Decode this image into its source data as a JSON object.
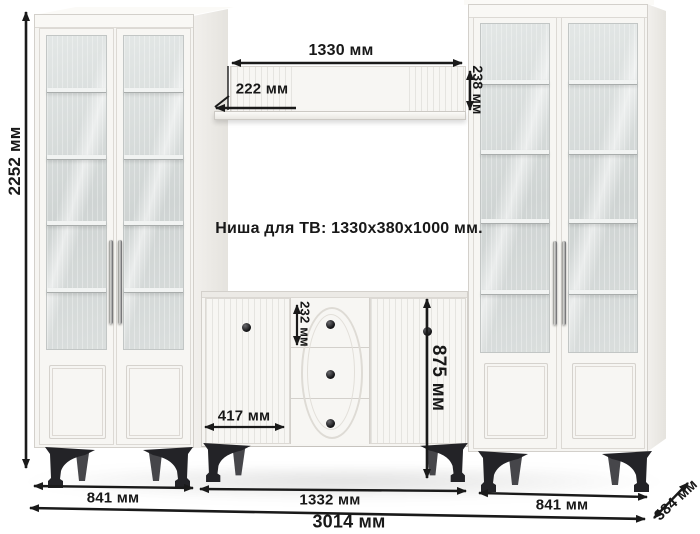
{
  "annotations": {
    "tv_niche_text": "Ниша для ТВ: 1330x380x1000 мм."
  },
  "dimensions": {
    "total_height": "2252 мм",
    "shelf_width": "1330 мм",
    "shelf_depth": "222 мм",
    "shelf_front_height": "238 мм",
    "top_drawer_height": "232 мм",
    "chest_height": "875 мм",
    "chest_door_width": "417 мм",
    "left_cabinet_width": "841 мм",
    "chest_section_width": "1332 мм",
    "right_cabinet_width": "841 мм",
    "total_width": "3014 мм",
    "unit_depth": "384 мм"
  },
  "colors": {
    "background": "#ffffff",
    "furniture_white": "#f6f5f2",
    "glass_tint": "#d6dbda",
    "leg_black": "#232327",
    "dimension_ink": "#1a1a1a"
  }
}
